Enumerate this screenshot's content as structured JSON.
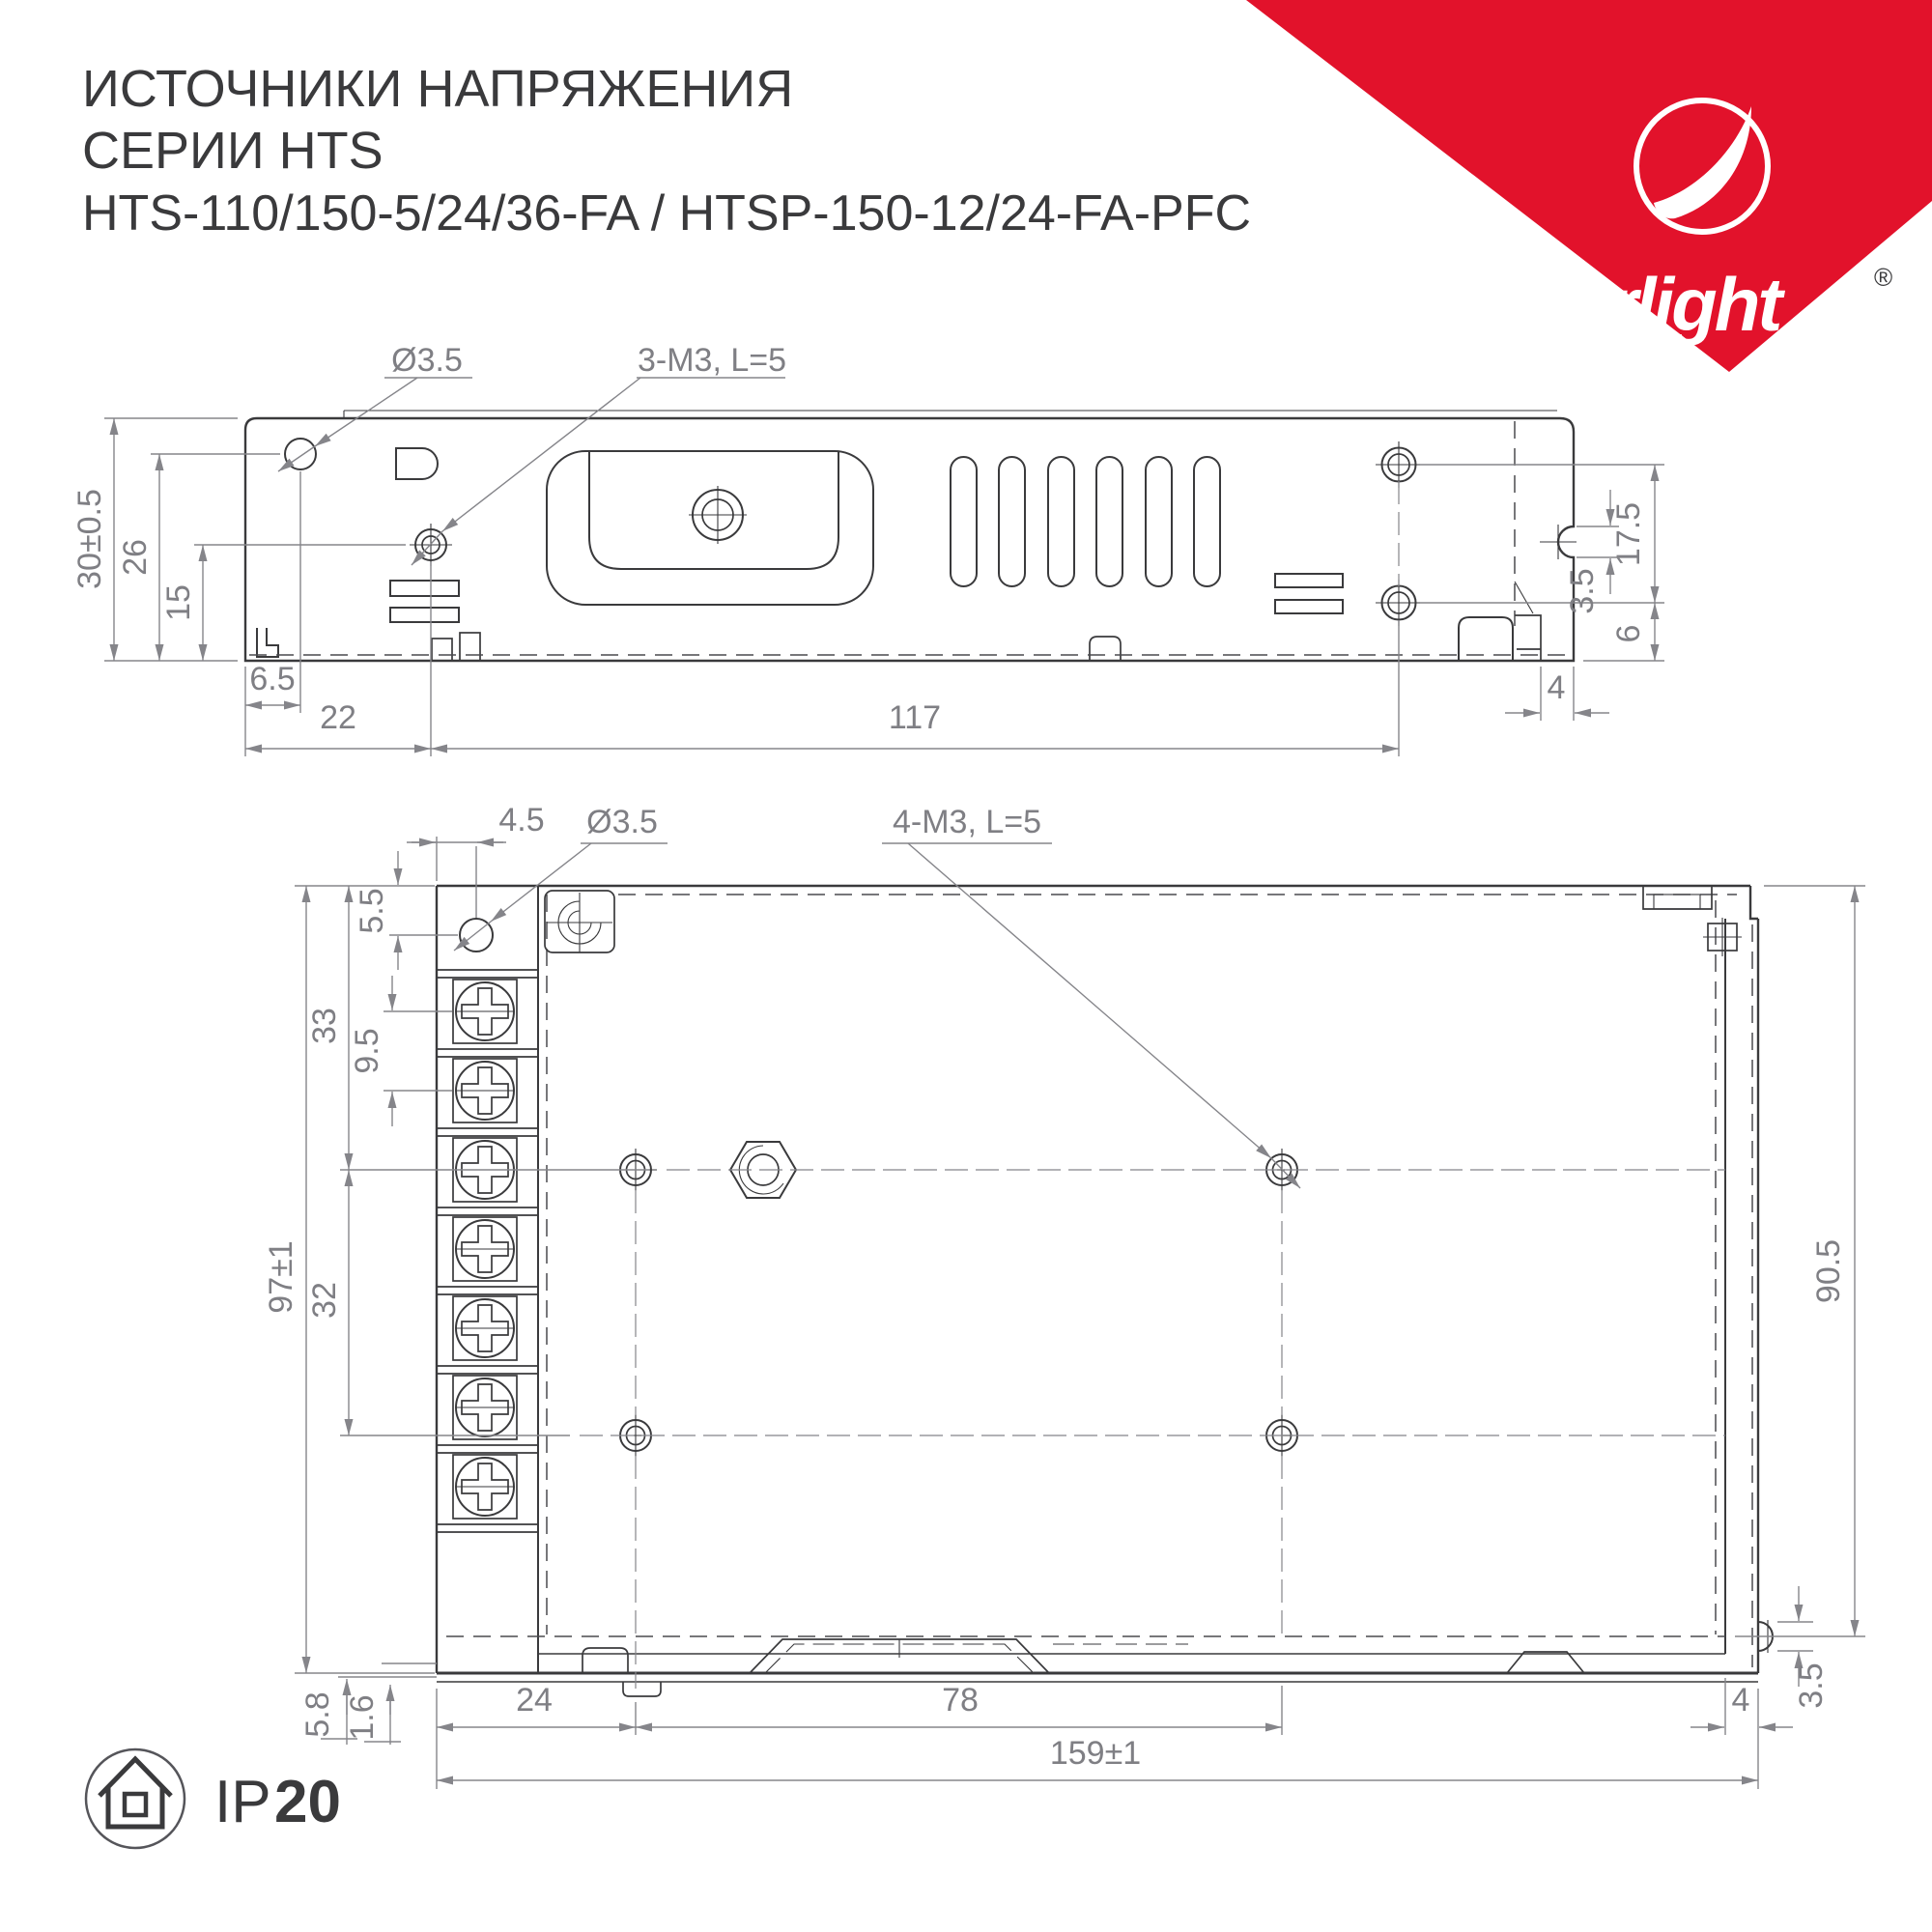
{
  "title": {
    "line1": "ИСТОЧНИКИ НАПРЯЖЕНИЯ",
    "line2": "СЕРИИ HTS",
    "line3": "HTS-110/150-5/24/36-FA / HTSP-150-12/24-FA-PFC"
  },
  "logo": {
    "wordmark": "arlight",
    "registered": "®"
  },
  "ip_badge": {
    "prefix": "IP",
    "rating": "20"
  },
  "colors": {
    "part_line": "#3a3a3c",
    "dim_line": "#85858a",
    "brand_red": "#e2122b",
    "background": "#ffffff"
  },
  "side_view": {
    "labels": {
      "hole_dia": "Ø3.5",
      "screw_spec": "3-M3, L=5"
    },
    "dims": {
      "overall_height": "30±0.5",
      "hole_height": "26",
      "screw_height": "15",
      "hole_offset": "6.5",
      "screw_offset": "22",
      "mount_span": "117",
      "tab_span": "17.5",
      "tab_slot": "3.5",
      "base_height": "6",
      "flange_width": "4"
    }
  },
  "top_view": {
    "labels": {
      "hole_dia": "Ø3.5",
      "screw_spec": "4-M3, L=5"
    },
    "dims": {
      "hole_inset_x": "4.5",
      "hole_inset_y": "5.5",
      "row1_offset": "33",
      "terminal_pitch": "9.5",
      "overall_width": "97±1",
      "row_span": "32",
      "body_depth": "90.5",
      "foot_height": "5.8",
      "plate_thickness": "1.6",
      "col1_offset": "24",
      "col_span": "78",
      "overall_length": "159±1",
      "flange_width": "4",
      "ear_slot": "3.5"
    }
  }
}
